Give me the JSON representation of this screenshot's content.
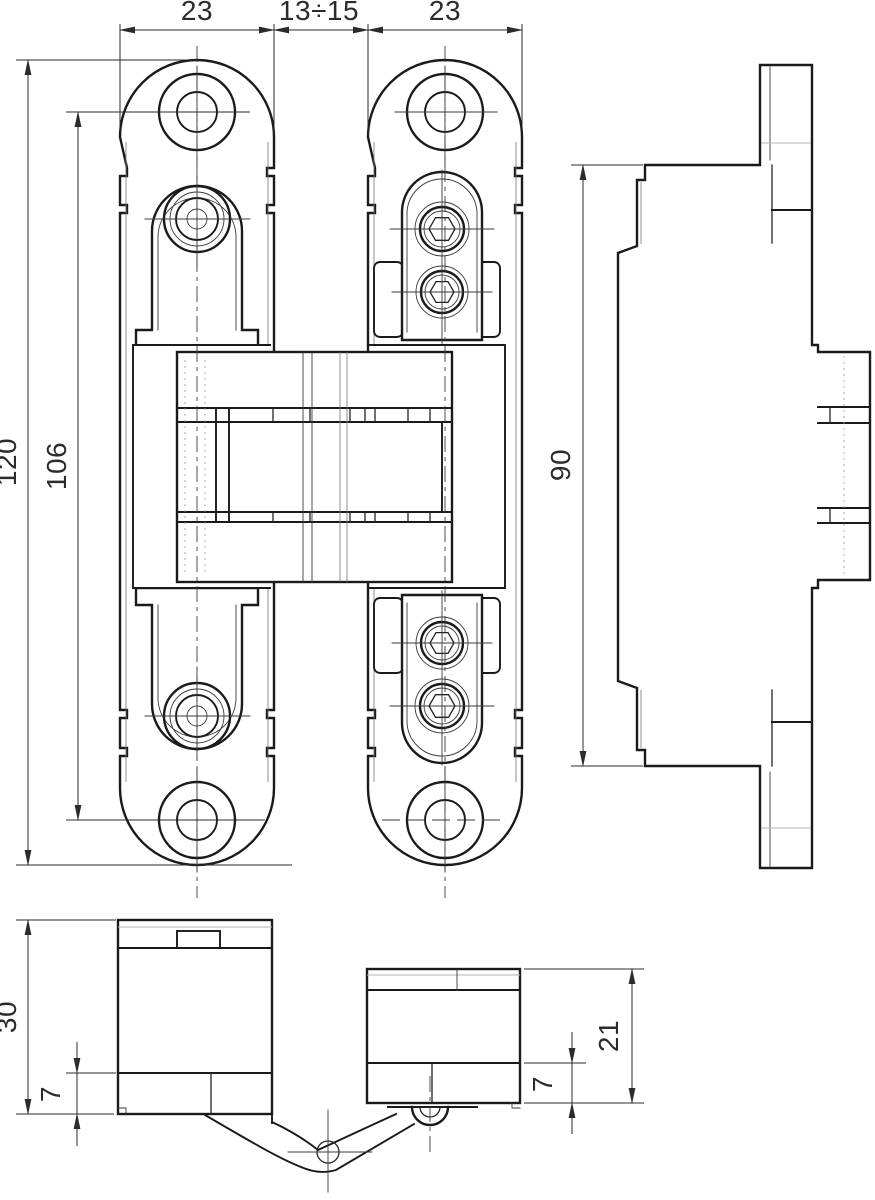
{
  "drawing": {
    "subject": "concealed-hinge-technical-drawing",
    "background_color": "#ffffff",
    "line_color": "#1a1a1a",
    "dim_color": "#2b2b2b",
    "views": {
      "front": {
        "label": "front-view",
        "dims": {
          "plate_width_left": "23",
          "gap": "13÷15",
          "plate_width_right": "23",
          "total_height": "120",
          "hole_spacing": "106"
        }
      },
      "side": {
        "label": "side-view",
        "dims": {
          "body_height": "90"
        }
      },
      "plan": {
        "label": "plan-view",
        "dims": {
          "left_body_depth": "30",
          "left_body_lip": "7",
          "right_body_depth": "21",
          "right_body_lip": "7"
        }
      }
    }
  }
}
